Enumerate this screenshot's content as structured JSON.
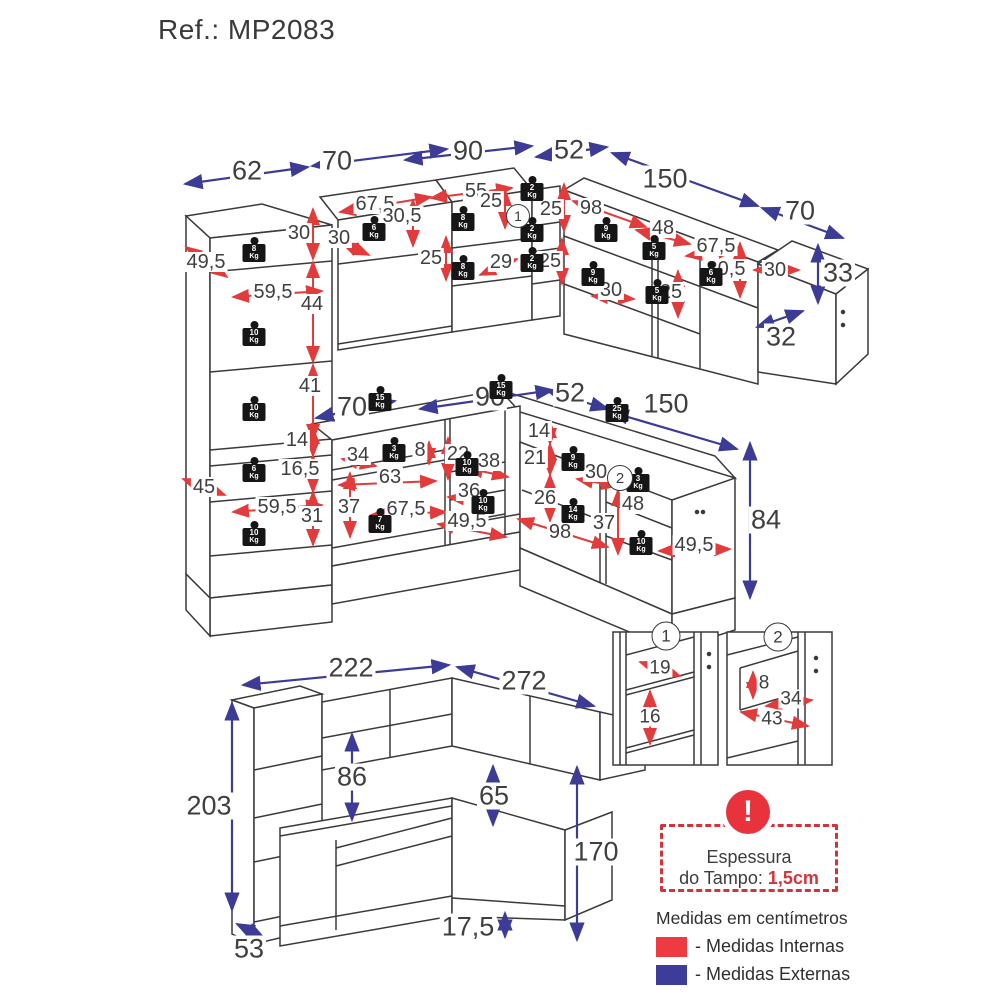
{
  "title": "Ref.: MP2083",
  "colors": {
    "internal": "#e23b3b",
    "external": "#3c3c96",
    "line_art": "#3a3a3a",
    "text": "#3f3f3f",
    "warning_red": "#e8333c",
    "legend_internal": "#ee3a41",
    "legend_external": "#3d3d99"
  },
  "warning": {
    "line1": "Espessura",
    "line2": "do Tampo: ",
    "value": "1,5cm"
  },
  "note": "Medidas em centímetros",
  "legend": {
    "internal": "- Medidas Internas",
    "external": "- Medidas Externas"
  },
  "weight_unit": "Kg",
  "diagram": {
    "labels": [
      {
        "t": "62",
        "x": 247,
        "y": 171,
        "s": 1
      },
      {
        "t": "70",
        "x": 337,
        "y": 161,
        "s": 1
      },
      {
        "t": "90",
        "x": 468,
        "y": 151,
        "s": 1
      },
      {
        "t": "52",
        "x": 569,
        "y": 150,
        "s": 1
      },
      {
        "t": "150",
        "x": 665,
        "y": 179,
        "s": 1
      },
      {
        "t": "70",
        "x": 800,
        "y": 211,
        "s": 1
      },
      {
        "t": "33",
        "x": 838,
        "y": 273,
        "s": 1
      },
      {
        "t": "32",
        "x": 781,
        "y": 337,
        "s": 1
      },
      {
        "t": "70",
        "x": 352,
        "y": 407,
        "s": 1
      },
      {
        "t": "90",
        "x": 490,
        "y": 397,
        "s": 1
      },
      {
        "t": "52",
        "x": 570,
        "y": 393,
        "s": 1
      },
      {
        "t": "150",
        "x": 666,
        "y": 404,
        "s": 1
      },
      {
        "t": "84",
        "x": 766,
        "y": 520,
        "s": 1
      },
      {
        "t": "222",
        "x": 351,
        "y": 668,
        "s": 1
      },
      {
        "t": "272",
        "x": 524,
        "y": 681,
        "s": 1
      },
      {
        "t": "203",
        "x": 209,
        "y": 806,
        "s": 1
      },
      {
        "t": "86",
        "x": 352,
        "y": 777,
        "s": 1
      },
      {
        "t": "65",
        "x": 494,
        "y": 796,
        "s": 1
      },
      {
        "t": "170",
        "x": 596,
        "y": 852,
        "s": 1
      },
      {
        "t": "17,5",
        "x": 468,
        "y": 927,
        "s": 1
      },
      {
        "t": "53",
        "x": 249,
        "y": 949,
        "s": 1
      },
      {
        "t": "49,5",
        "x": 206,
        "y": 262,
        "s": 2
      },
      {
        "t": "30",
        "x": 299,
        "y": 233,
        "s": 2
      },
      {
        "t": "59,5",
        "x": 273,
        "y": 292,
        "s": 2
      },
      {
        "t": "44",
        "x": 312,
        "y": 304,
        "s": 2
      },
      {
        "t": "41",
        "x": 310,
        "y": 386,
        "s": 2
      },
      {
        "t": "14",
        "x": 297,
        "y": 440,
        "s": 2
      },
      {
        "t": "16,5",
        "x": 300,
        "y": 469,
        "s": 2
      },
      {
        "t": "45",
        "x": 204,
        "y": 487,
        "s": 2
      },
      {
        "t": "59,5",
        "x": 277,
        "y": 507,
        "s": 2
      },
      {
        "t": "31",
        "x": 312,
        "y": 516,
        "s": 2
      },
      {
        "t": "67,5",
        "x": 375,
        "y": 204,
        "s": 2
      },
      {
        "t": "30,5",
        "x": 402,
        "y": 216,
        "s": 2
      },
      {
        "t": "30",
        "x": 339,
        "y": 238,
        "s": 2
      },
      {
        "t": "25",
        "x": 431,
        "y": 258,
        "s": 2
      },
      {
        "t": "55",
        "x": 476,
        "y": 191,
        "s": 2
      },
      {
        "t": "25",
        "x": 491,
        "y": 201,
        "s": 2
      },
      {
        "t": "29",
        "x": 501,
        "y": 262,
        "s": 2
      },
      {
        "t": "25",
        "x": 551,
        "y": 209,
        "s": 2
      },
      {
        "t": "25",
        "x": 550,
        "y": 261,
        "s": 2
      },
      {
        "t": "98",
        "x": 591,
        "y": 208,
        "s": 2
      },
      {
        "t": "48",
        "x": 663,
        "y": 228,
        "s": 2
      },
      {
        "t": "67,5",
        "x": 716,
        "y": 246,
        "s": 2
      },
      {
        "t": "30,5",
        "x": 726,
        "y": 269,
        "s": 2
      },
      {
        "t": "30",
        "x": 611,
        "y": 290,
        "s": 2
      },
      {
        "t": "25",
        "x": 671,
        "y": 292,
        "s": 2
      },
      {
        "t": "30",
        "x": 775,
        "y": 270,
        "s": 2
      },
      {
        "t": "34",
        "x": 358,
        "y": 455,
        "s": 2
      },
      {
        "t": "8",
        "x": 420,
        "y": 450,
        "s": 2
      },
      {
        "t": "63",
        "x": 390,
        "y": 477,
        "s": 2
      },
      {
        "t": "37",
        "x": 349,
        "y": 507,
        "s": 2
      },
      {
        "t": "67,5",
        "x": 406,
        "y": 509,
        "s": 2
      },
      {
        "t": "22",
        "x": 458,
        "y": 454,
        "s": 2
      },
      {
        "t": "38",
        "x": 489,
        "y": 461,
        "s": 2
      },
      {
        "t": "36",
        "x": 469,
        "y": 491,
        "s": 2
      },
      {
        "t": "49,5",
        "x": 467,
        "y": 521,
        "s": 2
      },
      {
        "t": "14",
        "x": 539,
        "y": 431,
        "s": 2
      },
      {
        "t": "21",
        "x": 535,
        "y": 458,
        "s": 2
      },
      {
        "t": "26",
        "x": 545,
        "y": 498,
        "s": 2
      },
      {
        "t": "30",
        "x": 596,
        "y": 472,
        "s": 2
      },
      {
        "t": "98",
        "x": 560,
        "y": 532,
        "s": 2
      },
      {
        "t": "48",
        "x": 633,
        "y": 504,
        "s": 2
      },
      {
        "t": "37",
        "x": 604,
        "y": 523,
        "s": 2
      },
      {
        "t": "49,5",
        "x": 694,
        "y": 545,
        "s": 2
      },
      {
        "t": "19",
        "x": 660,
        "y": 668,
        "s": 3
      },
      {
        "t": "16",
        "x": 650,
        "y": 717,
        "s": 3
      },
      {
        "t": "8",
        "x": 764,
        "y": 683,
        "s": 3
      },
      {
        "t": "34",
        "x": 791,
        "y": 699,
        "s": 3
      },
      {
        "t": "43",
        "x": 772,
        "y": 719,
        "s": 3
      }
    ],
    "weights": [
      {
        "v": "8",
        "x": 254,
        "y": 253
      },
      {
        "v": "10",
        "x": 254,
        "y": 337
      },
      {
        "v": "10",
        "x": 254,
        "y": 412
      },
      {
        "v": "6",
        "x": 254,
        "y": 473
      },
      {
        "v": "10",
        "x": 254,
        "y": 537
      },
      {
        "v": "6",
        "x": 374,
        "y": 232
      },
      {
        "v": "8",
        "x": 463,
        "y": 222
      },
      {
        "v": "8",
        "x": 463,
        "y": 271
      },
      {
        "v": "2",
        "x": 532,
        "y": 192
      },
      {
        "v": "2",
        "x": 532,
        "y": 233
      },
      {
        "v": "2",
        "x": 532,
        "y": 263
      },
      {
        "v": "9",
        "x": 606,
        "y": 233
      },
      {
        "v": "5",
        "x": 654,
        "y": 251
      },
      {
        "v": "9",
        "x": 593,
        "y": 277
      },
      {
        "v": "5",
        "x": 657,
        "y": 295
      },
      {
        "v": "6",
        "x": 711,
        "y": 277
      },
      {
        "v": "15",
        "x": 380,
        "y": 402
      },
      {
        "v": "15",
        "x": 501,
        "y": 390
      },
      {
        "v": "25",
        "x": 617,
        "y": 413
      },
      {
        "v": "3",
        "x": 394,
        "y": 453
      },
      {
        "v": "7",
        "x": 380,
        "y": 524
      },
      {
        "v": "10",
        "x": 467,
        "y": 467
      },
      {
        "v": "10",
        "x": 483,
        "y": 505
      },
      {
        "v": "9",
        "x": 573,
        "y": 462
      },
      {
        "v": "14",
        "x": 573,
        "y": 514
      },
      {
        "v": "3",
        "x": 638,
        "y": 483
      },
      {
        "v": "10",
        "x": 641,
        "y": 546
      }
    ],
    "markers": [
      {
        "t": "1",
        "x": 518,
        "y": 216,
        "d": 22
      },
      {
        "t": "2",
        "x": 620,
        "y": 478,
        "d": 24
      },
      {
        "t": "1",
        "x": 666,
        "y": 636,
        "d": 27
      },
      {
        "t": "2",
        "x": 778,
        "y": 637,
        "d": 27
      }
    ],
    "arrows": [
      {
        "x1": 185,
        "y1": 184,
        "x2": 308,
        "y2": 167,
        "c": "b"
      },
      {
        "x1": 312,
        "y1": 166,
        "x2": 447,
        "y2": 149,
        "c": "b"
      },
      {
        "x1": 405,
        "y1": 160,
        "x2": 532,
        "y2": 146,
        "c": "b"
      },
      {
        "x1": 536,
        "y1": 157,
        "x2": 607,
        "y2": 147,
        "c": "b"
      },
      {
        "x1": 612,
        "y1": 153,
        "x2": 758,
        "y2": 206,
        "c": "b"
      },
      {
        "x1": 762,
        "y1": 208,
        "x2": 843,
        "y2": 238,
        "c": "b"
      },
      {
        "x1": 818,
        "y1": 245,
        "x2": 818,
        "y2": 303,
        "c": "b"
      },
      {
        "x1": 757,
        "y1": 327,
        "x2": 803,
        "y2": 311,
        "c": "b"
      },
      {
        "x1": 316,
        "y1": 418,
        "x2": 395,
        "y2": 401,
        "c": "b"
      },
      {
        "x1": 420,
        "y1": 409,
        "x2": 553,
        "y2": 390,
        "c": "b"
      },
      {
        "x1": 549,
        "y1": 392,
        "x2": 608,
        "y2": 409,
        "c": "b"
      },
      {
        "x1": 611,
        "y1": 412,
        "x2": 737,
        "y2": 449,
        "c": "b"
      },
      {
        "x1": 750,
        "y1": 443,
        "x2": 750,
        "y2": 598,
        "c": "b"
      },
      {
        "x1": 243,
        "y1": 685,
        "x2": 449,
        "y2": 665,
        "c": "b"
      },
      {
        "x1": 457,
        "y1": 667,
        "x2": 594,
        "y2": 706,
        "c": "b"
      },
      {
        "x1": 232,
        "y1": 703,
        "x2": 232,
        "y2": 910,
        "c": "b"
      },
      {
        "x1": 352,
        "y1": 734,
        "x2": 352,
        "y2": 820,
        "c": "b"
      },
      {
        "x1": 493,
        "y1": 766,
        "x2": 493,
        "y2": 825,
        "c": "b"
      },
      {
        "x1": 577,
        "y1": 767,
        "x2": 577,
        "y2": 940,
        "c": "b"
      },
      {
        "x1": 505,
        "y1": 913,
        "x2": 505,
        "y2": 937,
        "c": "b"
      },
      {
        "x1": 237,
        "y1": 924,
        "x2": 264,
        "y2": 938,
        "c": "b"
      },
      {
        "x1": 186,
        "y1": 247,
        "x2": 227,
        "y2": 277,
        "c": "r"
      },
      {
        "x1": 313,
        "y1": 209,
        "x2": 313,
        "y2": 259,
        "c": "r"
      },
      {
        "x1": 233,
        "y1": 297,
        "x2": 322,
        "y2": 291,
        "c": "r"
      },
      {
        "x1": 313,
        "y1": 262,
        "x2": 313,
        "y2": 362,
        "c": "r"
      },
      {
        "x1": 313,
        "y1": 365,
        "x2": 313,
        "y2": 440,
        "c": "r"
      },
      {
        "x1": 313,
        "y1": 428,
        "x2": 313,
        "y2": 456,
        "c": "r"
      },
      {
        "x1": 313,
        "y1": 456,
        "x2": 313,
        "y2": 492,
        "c": "r"
      },
      {
        "x1": 183,
        "y1": 479,
        "x2": 225,
        "y2": 495,
        "c": "r"
      },
      {
        "x1": 233,
        "y1": 512,
        "x2": 322,
        "y2": 505,
        "c": "r"
      },
      {
        "x1": 313,
        "y1": 492,
        "x2": 313,
        "y2": 545,
        "c": "r"
      },
      {
        "x1": 340,
        "y1": 212,
        "x2": 431,
        "y2": 197,
        "c": "r"
      },
      {
        "x1": 413,
        "y1": 200,
        "x2": 413,
        "y2": 246,
        "c": "r"
      },
      {
        "x1": 342,
        "y1": 243,
        "x2": 369,
        "y2": 255,
        "c": "r"
      },
      {
        "x1": 446,
        "y1": 237,
        "x2": 446,
        "y2": 280,
        "c": "r"
      },
      {
        "x1": 431,
        "y1": 198,
        "x2": 512,
        "y2": 188,
        "c": "r"
      },
      {
        "x1": 505,
        "y1": 190,
        "x2": 505,
        "y2": 228,
        "c": "r"
      },
      {
        "x1": 480,
        "y1": 275,
        "x2": 517,
        "y2": 259,
        "c": "r"
      },
      {
        "x1": 564,
        "y1": 184,
        "x2": 564,
        "y2": 231,
        "c": "r"
      },
      {
        "x1": 562,
        "y1": 239,
        "x2": 562,
        "y2": 284,
        "c": "r"
      },
      {
        "x1": 573,
        "y1": 201,
        "x2": 646,
        "y2": 227,
        "c": "r"
      },
      {
        "x1": 636,
        "y1": 230,
        "x2": 690,
        "y2": 244,
        "c": "r"
      },
      {
        "x1": 686,
        "y1": 256,
        "x2": 734,
        "y2": 250,
        "c": "r"
      },
      {
        "x1": 740,
        "y1": 243,
        "x2": 740,
        "y2": 297,
        "c": "r"
      },
      {
        "x1": 592,
        "y1": 296,
        "x2": 634,
        "y2": 299,
        "c": "r"
      },
      {
        "x1": 678,
        "y1": 271,
        "x2": 678,
        "y2": 317,
        "c": "r"
      },
      {
        "x1": 754,
        "y1": 270,
        "x2": 799,
        "y2": 270,
        "c": "r"
      },
      {
        "x1": 342,
        "y1": 459,
        "x2": 376,
        "y2": 466,
        "c": "r"
      },
      {
        "x1": 429,
        "y1": 442,
        "x2": 429,
        "y2": 464,
        "c": "r"
      },
      {
        "x1": 339,
        "y1": 485,
        "x2": 436,
        "y2": 481,
        "c": "r"
      },
      {
        "x1": 350,
        "y1": 473,
        "x2": 350,
        "y2": 537,
        "c": "r"
      },
      {
        "x1": 371,
        "y1": 515,
        "x2": 446,
        "y2": 512,
        "c": "r"
      },
      {
        "x1": 448,
        "y1": 438,
        "x2": 448,
        "y2": 479,
        "c": "r"
      },
      {
        "x1": 467,
        "y1": 468,
        "x2": 508,
        "y2": 477,
        "c": "r"
      },
      {
        "x1": 448,
        "y1": 497,
        "x2": 492,
        "y2": 501,
        "c": "r"
      },
      {
        "x1": 438,
        "y1": 524,
        "x2": 506,
        "y2": 537,
        "c": "r"
      },
      {
        "x1": 550,
        "y1": 422,
        "x2": 550,
        "y2": 444,
        "c": "r"
      },
      {
        "x1": 550,
        "y1": 444,
        "x2": 550,
        "y2": 475,
        "c": "r"
      },
      {
        "x1": 550,
        "y1": 475,
        "x2": 550,
        "y2": 521,
        "c": "r"
      },
      {
        "x1": 577,
        "y1": 479,
        "x2": 617,
        "y2": 486,
        "c": "r"
      },
      {
        "x1": 518,
        "y1": 519,
        "x2": 608,
        "y2": 547,
        "c": "r"
      },
      {
        "x1": 618,
        "y1": 490,
        "x2": 618,
        "y2": 554,
        "c": "r"
      },
      {
        "x1": 659,
        "y1": 551,
        "x2": 730,
        "y2": 549,
        "c": "r"
      },
      {
        "x1": 640,
        "y1": 662,
        "x2": 680,
        "y2": 676,
        "c": "r"
      },
      {
        "x1": 650,
        "y1": 691,
        "x2": 650,
        "y2": 744,
        "c": "r"
      },
      {
        "x1": 753,
        "y1": 672,
        "x2": 753,
        "y2": 698,
        "c": "r"
      },
      {
        "x1": 766,
        "y1": 706,
        "x2": 812,
        "y2": 700,
        "c": "r"
      },
      {
        "x1": 741,
        "y1": 712,
        "x2": 808,
        "y2": 726,
        "c": "r"
      }
    ]
  }
}
